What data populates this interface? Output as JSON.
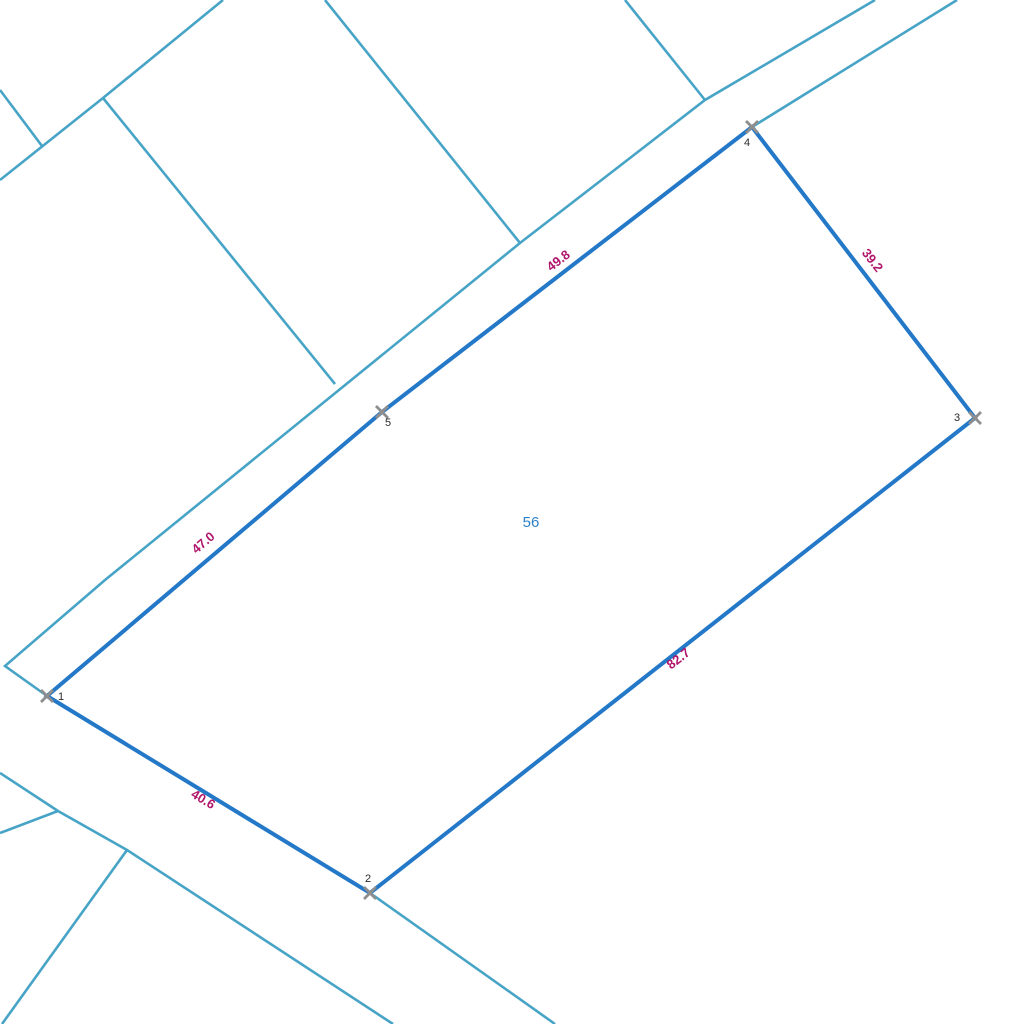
{
  "map": {
    "background_color": "#ffffff",
    "colors": {
      "background_line": "#47a4c6",
      "parcel_boundary": "#2478c8",
      "edge_label": "#b0156b",
      "parcel_number": "#2e80c6",
      "vertex_marker": "#8e8e8e",
      "vertex_label": "#2a2a2a"
    },
    "background_lines": [
      {
        "name": "boundary-line",
        "points": [
          [
            223,
            0
          ],
          [
            103,
            98
          ]
        ]
      },
      {
        "name": "boundary-line",
        "points": [
          [
            103,
            98
          ],
          [
            0,
            180
          ]
        ]
      },
      {
        "name": "boundary-line",
        "points": [
          [
            0,
            90
          ],
          [
            42,
            146
          ]
        ]
      },
      {
        "name": "boundary-line",
        "points": [
          [
            103,
            98
          ],
          [
            335,
            384
          ]
        ]
      },
      {
        "name": "boundary-line",
        "points": [
          [
            325,
            0
          ],
          [
            520,
            243
          ]
        ]
      },
      {
        "name": "boundary-line",
        "points": [
          [
            625,
            0
          ],
          [
            705,
            100
          ]
        ]
      },
      {
        "name": "road-edge-line",
        "points": [
          [
            875,
            0
          ],
          [
            705,
            100
          ],
          [
            520,
            243
          ],
          [
            105,
            580
          ],
          [
            5,
            666
          ],
          [
            47,
            696
          ]
        ]
      },
      {
        "name": "road-edge-line",
        "points": [
          [
            957,
            0
          ],
          [
            752,
            127
          ]
        ]
      },
      {
        "name": "boundary-line",
        "points": [
          [
            0,
            773
          ],
          [
            58,
            811
          ]
        ]
      },
      {
        "name": "boundary-line",
        "points": [
          [
            0,
            833
          ],
          [
            58,
            811
          ]
        ]
      },
      {
        "name": "road-edge-line",
        "points": [
          [
            58,
            811
          ],
          [
            127,
            850
          ],
          [
            393,
            1024
          ]
        ]
      },
      {
        "name": "boundary-line",
        "points": [
          [
            127,
            850
          ],
          [
            2,
            1024
          ]
        ]
      },
      {
        "name": "road-edge-line",
        "points": [
          [
            370,
            893
          ],
          [
            555,
            1024
          ]
        ]
      }
    ],
    "parcel": {
      "number": "56",
      "number_pos": {
        "x": 531,
        "y": 527
      },
      "vertices": [
        {
          "n": "1",
          "x": 47,
          "y": 696,
          "label_dx": 14,
          "label_dy": 4
        },
        {
          "n": "2",
          "x": 370,
          "y": 893,
          "label_dx": -2,
          "label_dy": -11
        },
        {
          "n": "3",
          "x": 975,
          "y": 418,
          "label_dx": -18,
          "label_dy": 3
        },
        {
          "n": "4",
          "x": 752,
          "y": 127,
          "label_dx": -5,
          "label_dy": 19
        },
        {
          "n": "5",
          "x": 382,
          "y": 412,
          "label_dx": 6,
          "label_dy": 14
        }
      ],
      "edge_labels": [
        {
          "text": "40.6",
          "x": 201,
          "y": 803,
          "angle": 31
        },
        {
          "text": "82.7",
          "x": 681,
          "y": 662,
          "angle": -38
        },
        {
          "text": "39.2",
          "x": 869,
          "y": 263,
          "angle": 52
        },
        {
          "text": "49.8",
          "x": 561,
          "y": 264,
          "angle": -37.5
        },
        {
          "text": "47.0",
          "x": 206,
          "y": 546,
          "angle": -40.5
        }
      ]
    }
  }
}
